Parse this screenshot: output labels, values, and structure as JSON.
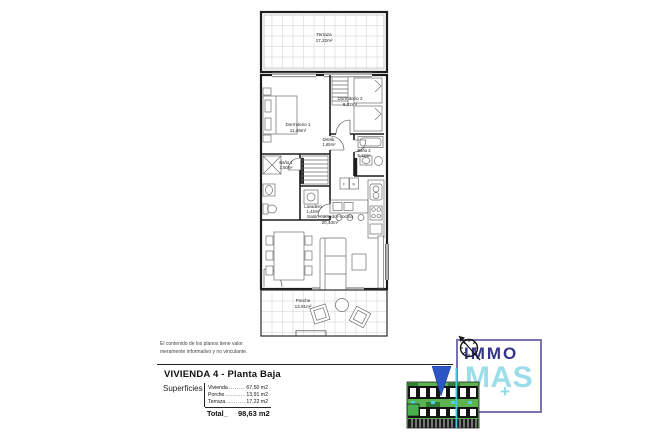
{
  "plan": {
    "rooms": [
      {
        "name": "Terraza",
        "area": "17,22m²"
      },
      {
        "name": "Dormitorio 1",
        "area": "11,46m²"
      },
      {
        "name": "Dormitorio 2",
        "area": "8,32m²"
      },
      {
        "name": "Distrib.",
        "area": "1,65m²"
      },
      {
        "name": "Baño 2",
        "area": "5,12m²"
      },
      {
        "name": "Baño 1",
        "area": "3,50m²"
      },
      {
        "name": "Lavadero",
        "area": "1,43m²"
      },
      {
        "name": "Salón-comedor-cocina",
        "area": "20,40m²"
      },
      {
        "name": "Porche",
        "area": "13,91m²"
      }
    ],
    "kitchen_units": [
      "F",
      "N"
    ],
    "colors": {
      "wall": "#1d1d1d",
      "grid": "#c9c9c9",
      "furniture": "#6e6e6e"
    }
  },
  "disclaimer": {
    "line1": "El contenido de los planos tiene valor",
    "line2": "meramente informativo y no vinculante."
  },
  "title_block": {
    "title": "VIVIENDA 4 - Planta Baja",
    "superficies_label": "Superficies",
    "rows": [
      {
        "label": "Vivienda",
        "dots": "..............",
        "value": "67,50 m2"
      },
      {
        "label": "Porche",
        "dots": "..............",
        "value": "13,91 m2"
      },
      {
        "label": "Terraza",
        "dots": "..............",
        "value": "17,22 m2"
      }
    ],
    "total_label": "Total_",
    "total_value": "98,63 m2"
  },
  "logo": {
    "line1": "IMMO",
    "line2": "MAS",
    "plus": "+",
    "colors": {
      "immo": "#34348a",
      "mas": "#9bdde9",
      "border": "#6864ac",
      "marker_arrow": "#2d56c5"
    }
  }
}
